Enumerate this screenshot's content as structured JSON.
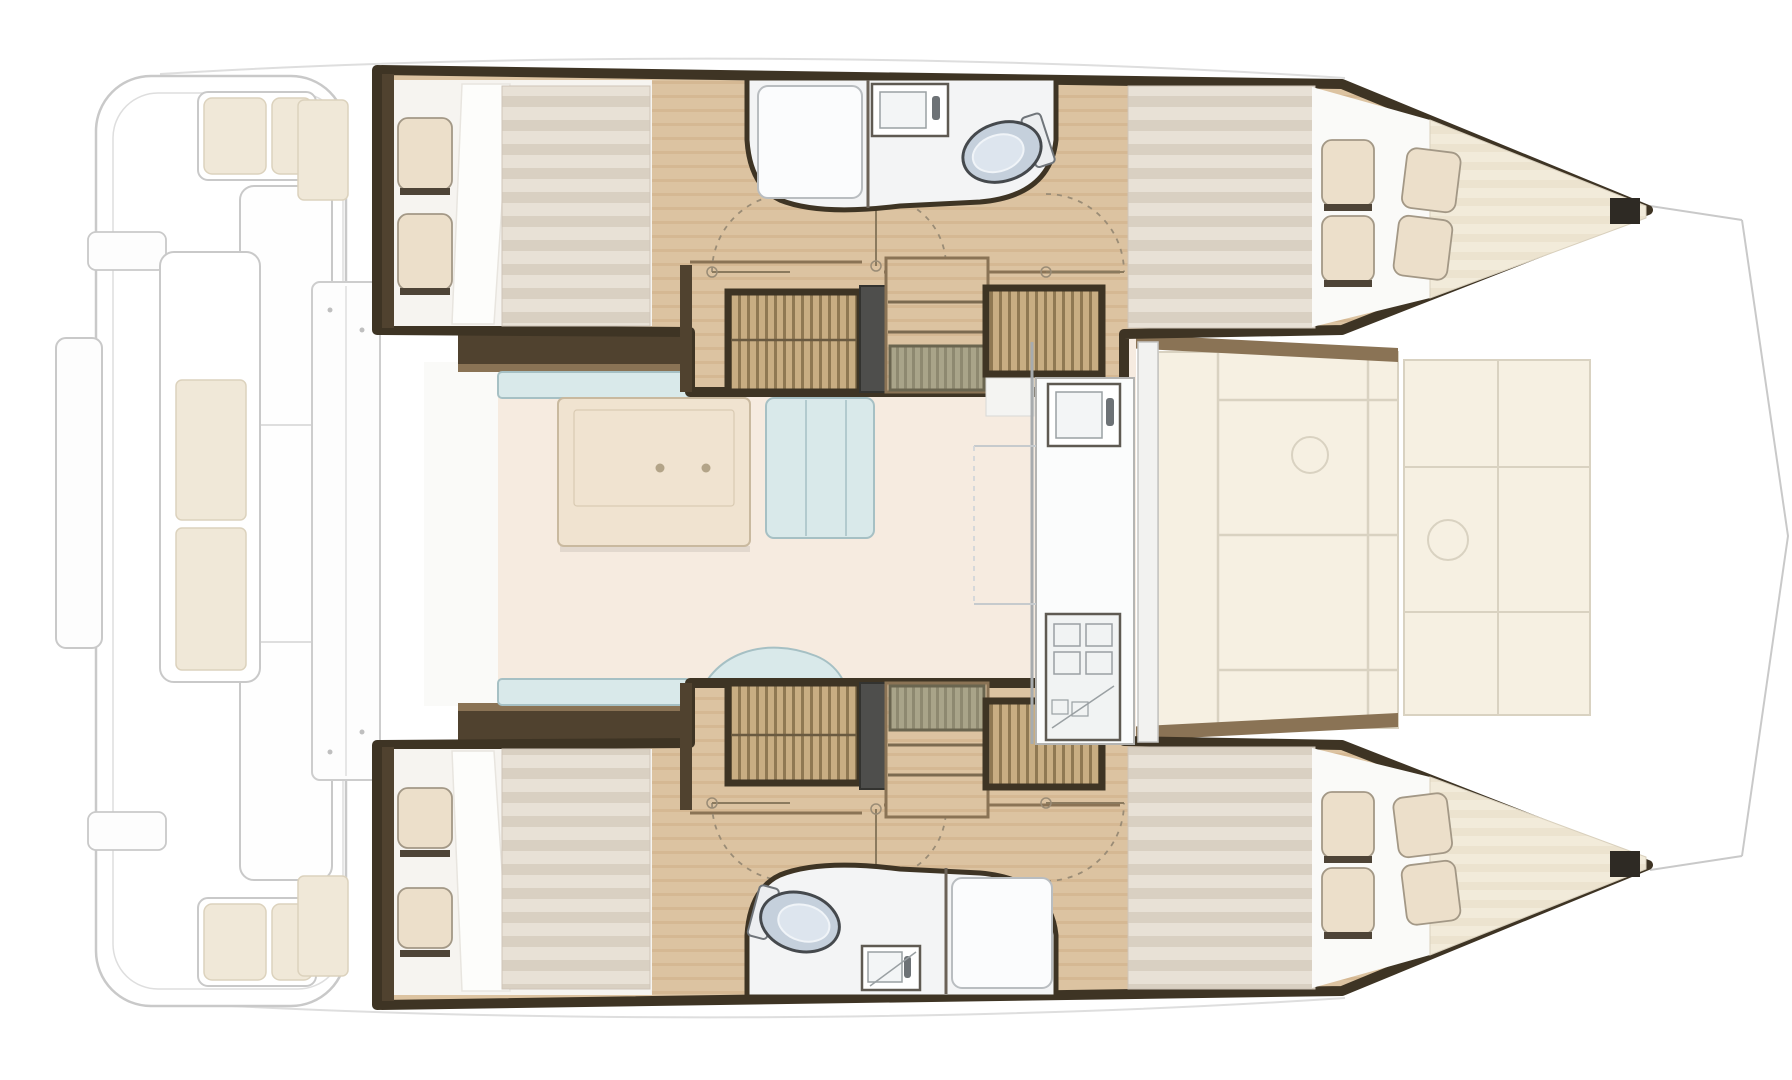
{
  "diagram": {
    "title": "Catamaran interior layout floor plan, top view, bow to the right",
    "orientation": {
      "bow": "right",
      "stern": "left"
    },
    "areas": {
      "aft_cockpit": [
        "transom steps",
        "side bench",
        "corner seats with cushions",
        "aft-facing bench with cushions"
      ],
      "saloon": [
        "u-shaped settee",
        "dining table with two cup holders",
        "chaise seat",
        "curved chaise"
      ],
      "galley": [
        "sink unit with faucet",
        "stove with burners",
        "counter"
      ],
      "port_hull": [
        "aft double cabin with pillows and mattress",
        "bathroom with shower, washbasin and toilet",
        "wardrobe",
        "companionway stairs",
        "wardrobe",
        "forward double berth tapering to bow"
      ],
      "starboard_hull": [
        "aft double cabin with pillows and mattress",
        "bathroom with toilet, washbasin and shower",
        "wardrobe",
        "companionway stairs",
        "wardrobe",
        "forward double berth tapering to bow"
      ],
      "forward_cockpit": [
        "lounge cushion panels"
      ],
      "bow": [
        "trampoline rigging (ghosted outline)"
      ]
    }
  },
  "colors": {
    "wall-dark": "#3e3424",
    "wall-dark2": "#50422f",
    "wall-mid": "#8a7355",
    "wood-1": "#dcc3a1",
    "wood-2": "#cfae87",
    "slat-1": "#c8ad82",
    "slat-2": "#8f7852",
    "step-1": "#a9a489",
    "step-2": "#8e8970",
    "seat-blue": "#d9e9ea",
    "seat-blue-edge": "#a6c0c4",
    "saloon-floor": "#f6ebe0",
    "table": "#f0e3d0",
    "table-edge": "#c9b99f",
    "mattress-1": "#e8e1d6",
    "mattress-2": "#d9d0c2",
    "pillow": "#ecdfca",
    "pillow-edge": "#a39886",
    "duvet": "#fdfdfb",
    "cushion": "#f0e8d8",
    "cushion-edge": "#dcd2bd",
    "bow-1": "#f2ebda",
    "bow-2": "#ece3cf",
    "fwd-panel": "#f6f0e2",
    "fwd-panel-edge": "#d9d2c1",
    "bath-floor": "#f3f4f5",
    "toilet": "#c5d0dc",
    "toilet-edge": "#45494d",
    "fixture-edge": "#5f5a52",
    "ghost": "#c9c9c9",
    "ghost-soft": "#dedede",
    "white-floor": "#f6f4f0"
  }
}
